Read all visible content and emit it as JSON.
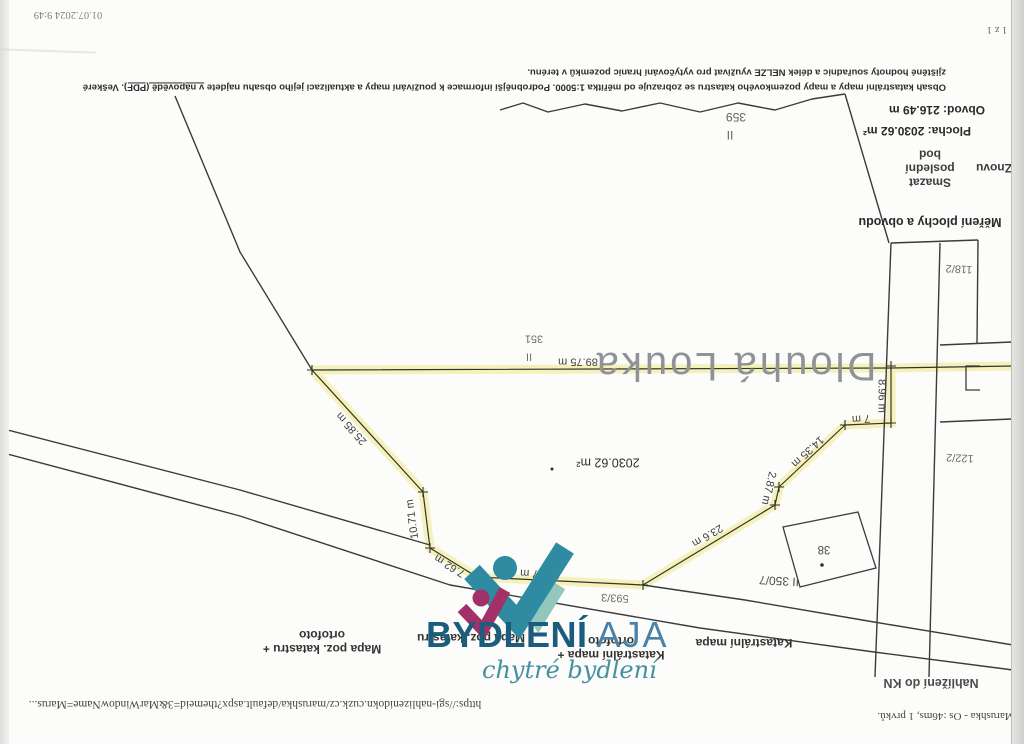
{
  "scan": {
    "print_header": {
      "app_status": "Marushka - Os :46ms, 1 prvků.",
      "url": "https://sgi-nahlizenidokn.cuzk.cz/marushka/default.aspx?themeid=3&MarWindowName=Marus...",
      "date": "01.07.2024 9:49",
      "page": "1 z 1"
    },
    "app_title": "Nahlížení do KN",
    "map_layer_tabs": [
      {
        "label": "Mapa poz. katastru + ortofoto"
      },
      {
        "label": "Mapa poz. katastru"
      },
      {
        "label": "Katastrální mapa + ortofoto"
      },
      {
        "label": "Katastrální mapa"
      }
    ],
    "measure_panel": {
      "title": "Měření plochy a obvodu",
      "undo_button": "Znovu",
      "delete_last_button": "Smazat poslední bod",
      "area": "Plocha: 2030.62 m²",
      "perimeter": "Obvod: 216.49 m"
    },
    "disclaimer": {
      "part1": "Obsah katastrální mapy a mapy pozemkového katastru se zobrazuje od měřítka 1:5000. Podrobnější informace k používání mapy a aktualizaci jejího obsahu najdete ",
      "link": "v nápovědě (PDF)",
      "part2": ". Veškeré zjištěné hodnoty souřadnic a délek NELZE využívat pro vytyčování hranic pozemků v terénu."
    }
  },
  "map": {
    "highlight_color": "#f4f0b4",
    "place_name": "Dlouhá Louka",
    "measured_area_m2": "2030.62 m²",
    "measured_perimeter_m": "216.49 m",
    "labels": [
      {
        "name": "place-name-dlouha-louka",
        "text": "Dlouhá Louka",
        "x": 735,
        "y": 366,
        "rot": 180,
        "size": 40,
        "color": "#8f9296",
        "weight": 500,
        "ls": 3
      },
      {
        "name": "dist-89-75",
        "text": "89.75 m",
        "x": 578,
        "y": 361,
        "rot": 180,
        "size": 11
      },
      {
        "name": "parcel-351",
        "text": "351",
        "x": 534,
        "y": 338,
        "rot": 180,
        "size": 11,
        "color": "#707070"
      },
      {
        "name": "landuse-ii-351",
        "text": "II",
        "x": 529,
        "y": 356,
        "rot": 180,
        "size": 11,
        "color": "#707070"
      },
      {
        "name": "parcel-359",
        "text": "359",
        "x": 736,
        "y": 117,
        "rot": 180,
        "size": 12,
        "color": "#606060"
      },
      {
        "name": "landuse-ii-359",
        "text": "II",
        "x": 730,
        "y": 135,
        "rot": 180,
        "size": 12,
        "color": "#606060"
      },
      {
        "name": "area-label-2030-62",
        "text": "2030.62 m²",
        "x": 608,
        "y": 462,
        "rot": 180,
        "size": 12.5,
        "color": "#2f2f2f"
      },
      {
        "name": "dist-25-85",
        "text": "25.85 m",
        "x": 352,
        "y": 428,
        "rot": 228,
        "size": 11
      },
      {
        "name": "dist-10-71",
        "text": "10.71 m",
        "x": 413,
        "y": 519,
        "rot": 262,
        "size": 11
      },
      {
        "name": "dist-7-62",
        "text": "7.62 m",
        "x": 450,
        "y": 565,
        "rot": 212,
        "size": 11
      },
      {
        "name": "dist-25-77",
        "text": "25.77 m",
        "x": 540,
        "y": 573,
        "rot": 183,
        "size": 11
      },
      {
        "name": "parcel-593-3",
        "text": "593/3",
        "x": 615,
        "y": 597,
        "rot": 183,
        "size": 11,
        "color": "#6b6b6b"
      },
      {
        "name": "dist-23-6",
        "text": "23.6 m",
        "x": 707,
        "y": 535,
        "rot": 149,
        "size": 11
      },
      {
        "name": "dist-2-87",
        "text": "2.87 m",
        "x": 768,
        "y": 488,
        "rot": 103,
        "size": 11
      },
      {
        "name": "dist-14-35",
        "text": "14.35 m",
        "x": 807,
        "y": 451,
        "rot": 137,
        "size": 11
      },
      {
        "name": "dist-7",
        "text": "7 m",
        "x": 861,
        "y": 418,
        "rot": 177,
        "size": 11
      },
      {
        "name": "dist-8-96",
        "text": "8.96 m",
        "x": 881,
        "y": 396,
        "rot": 90,
        "size": 11
      },
      {
        "name": "parcel-ii-350-7",
        "text": "II 350/7",
        "x": 779,
        "y": 581,
        "rot": 183,
        "size": 12,
        "color": "#4f4f4f"
      },
      {
        "name": "building-38",
        "text": "38",
        "x": 824,
        "y": 548,
        "rot": 180,
        "size": 11.5,
        "color": "#4f4f4f"
      },
      {
        "name": "parcel-118-2",
        "text": "118/2",
        "x": 959,
        "y": 268,
        "rot": 183,
        "size": 11,
        "color": "#6b6b6b"
      },
      {
        "name": "parcel-122-2",
        "text": "122/2",
        "x": 960,
        "y": 457,
        "rot": 183,
        "size": 11,
        "color": "#6b6b6b"
      }
    ]
  },
  "watermark": {
    "brand_bold": "BYDLENÍ",
    "brand_light": "AJA",
    "tagline": "chytré bydlení",
    "colors": {
      "teal": "#2e8ba1",
      "mint": "#93c7bb",
      "magenta": "#a23168",
      "text_dark": "#1c5c7d",
      "text_light": "#4a81a8",
      "tagline": "#43909f"
    }
  }
}
